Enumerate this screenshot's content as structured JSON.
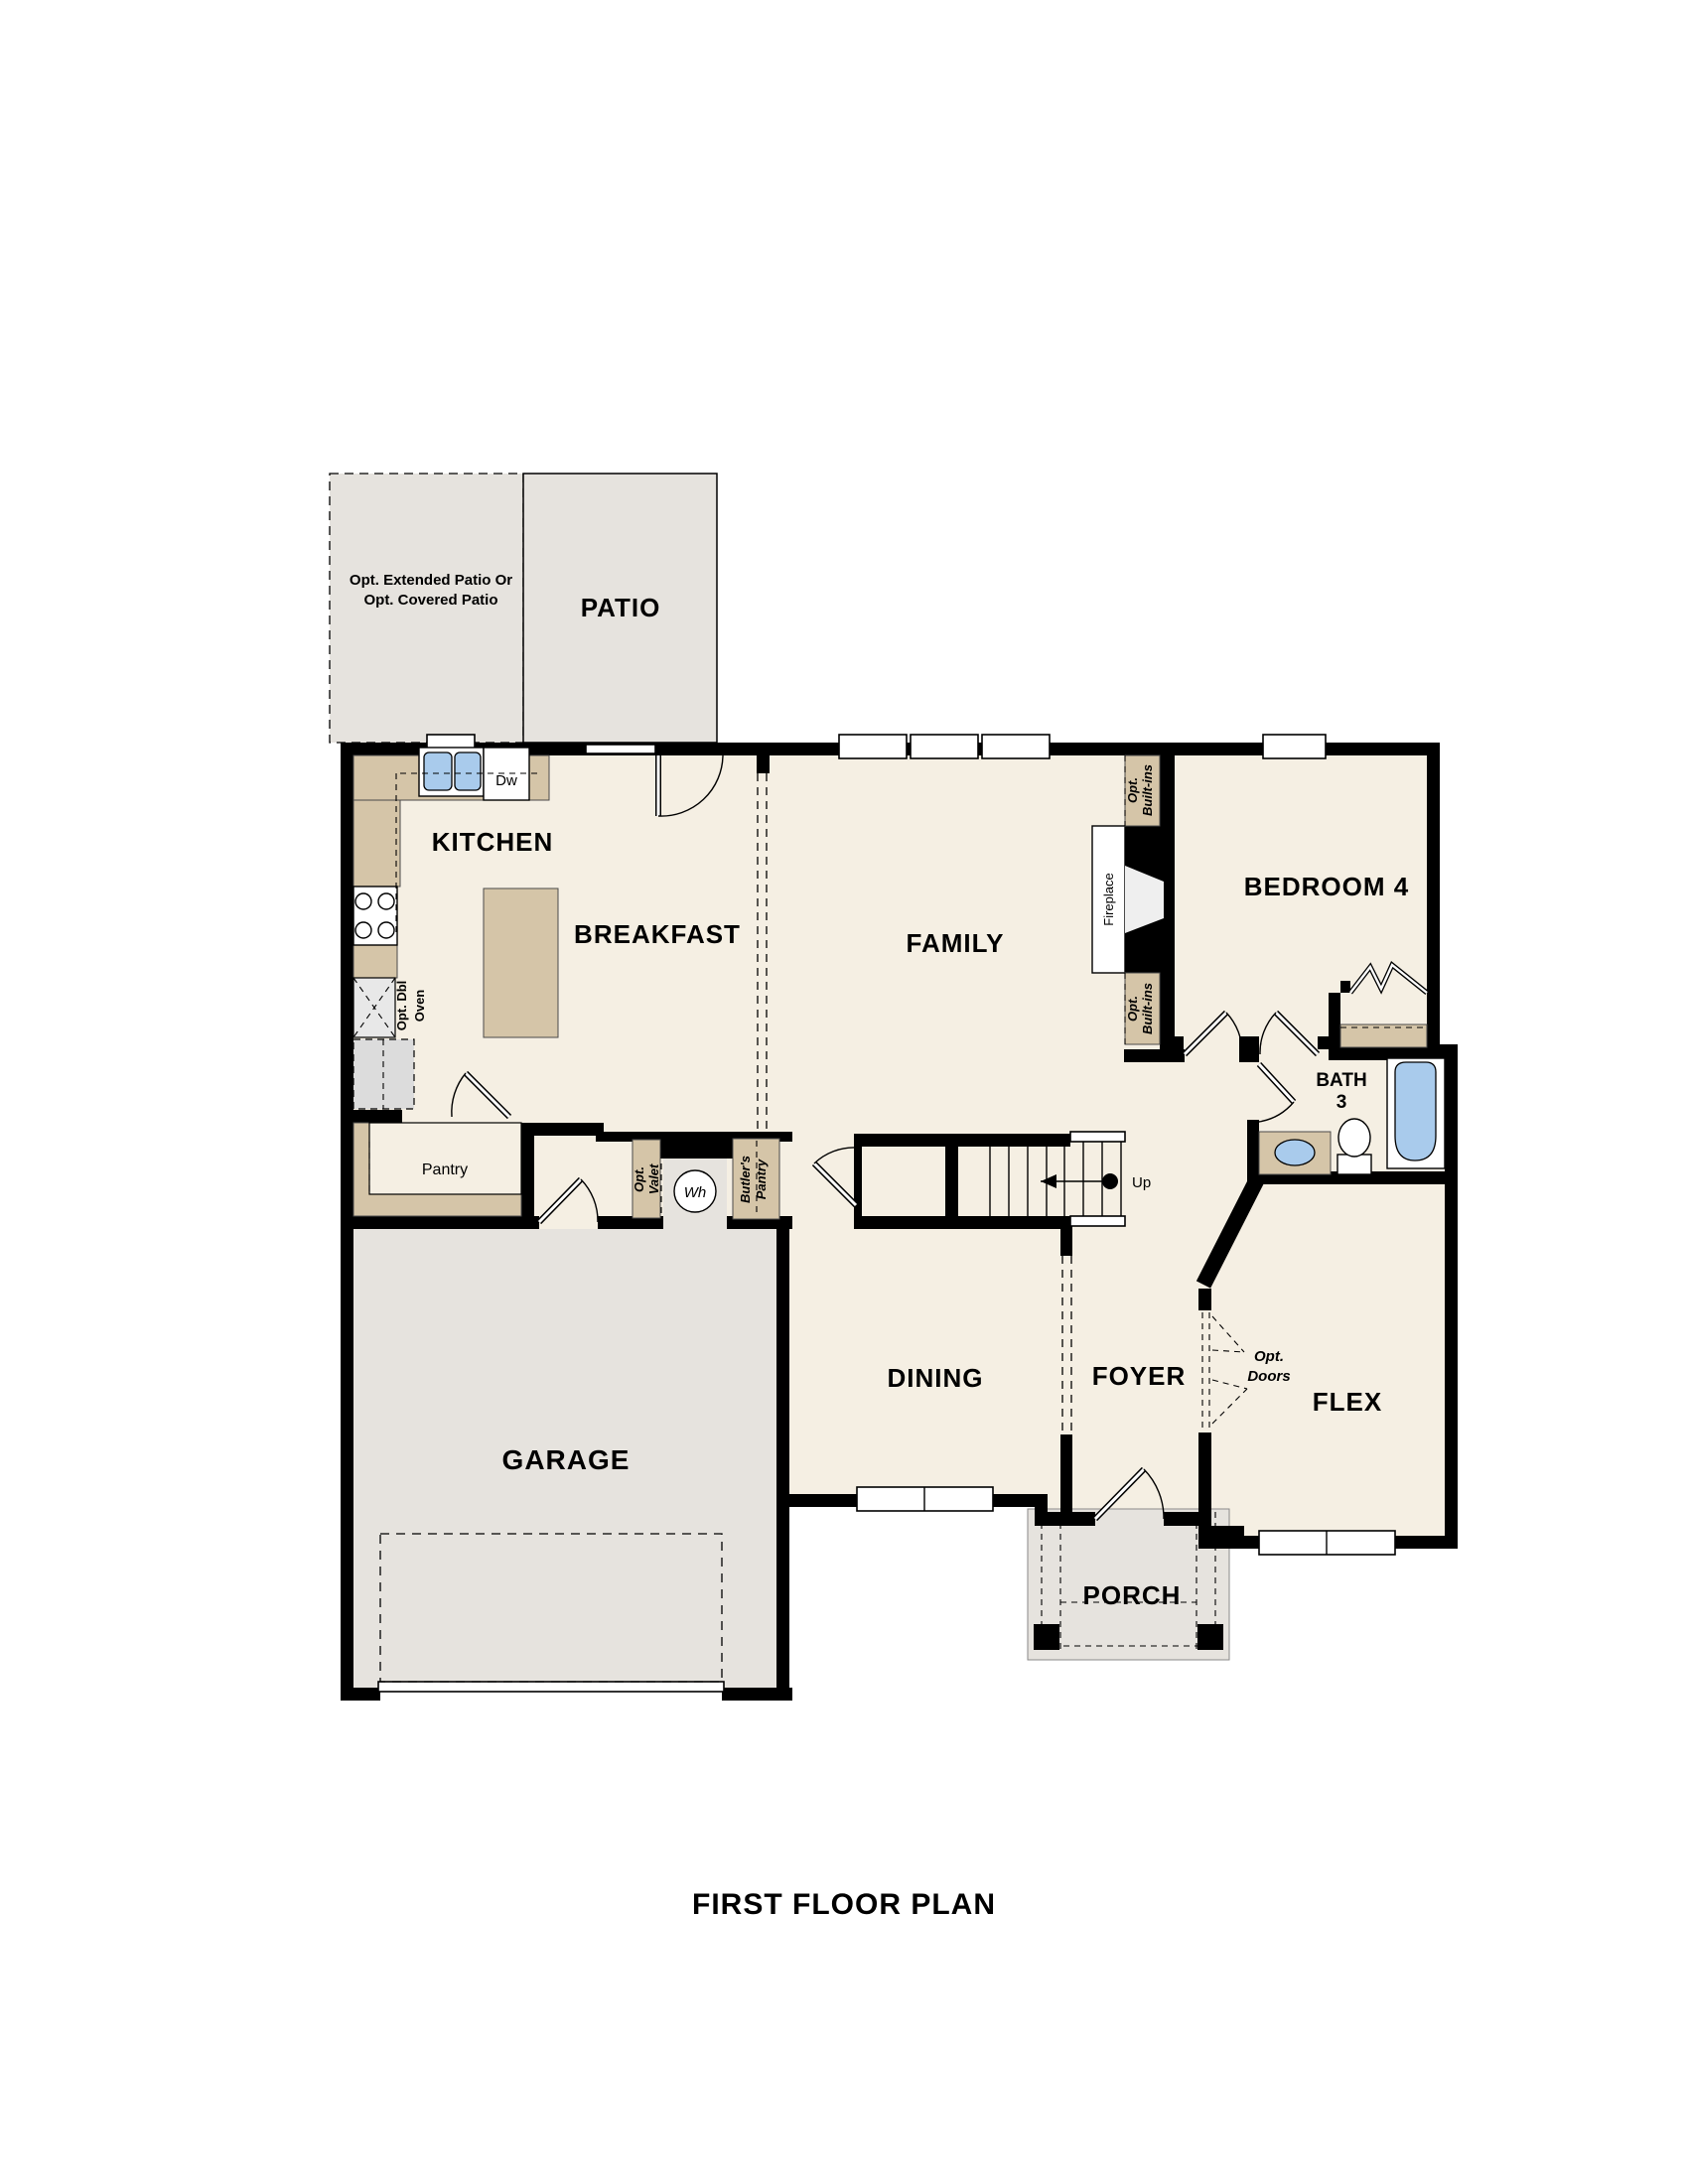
{
  "title": "FIRST FLOOR PLAN",
  "rooms": {
    "patio": "PATIO",
    "kitchen": "KITCHEN",
    "breakfast": "BREAKFAST",
    "family": "FAMILY",
    "bedroom4": "BEDROOM 4",
    "bath_line1": "BATH",
    "bath_line2": "3",
    "dining": "DINING",
    "foyer": "FOYER",
    "flex": "FLEX",
    "garage": "GARAGE",
    "porch": "PORCH",
    "pantry": "Pantry"
  },
  "labels": {
    "dw": "Dw",
    "wh": "Wh",
    "up": "Up",
    "fireplace": "Fireplace",
    "opt_patio_line1": "Opt. Extended Patio Or",
    "opt_patio_line2": "Opt. Covered Patio",
    "opt_doors_line1": "Opt.",
    "opt_doors_line2": "Doors",
    "opt_dbl_oven_line1": "Opt. Dbl",
    "opt_dbl_oven_line2": "Oven",
    "opt_valet_line1": "Opt.",
    "opt_valet_line2": "Valet",
    "butlers_line1": "Butler's",
    "butlers_line2": "Pantry",
    "builtins_line1": "Opt.",
    "builtins_line2": "Built-ins"
  },
  "colors": {
    "floor": "#f5efe3",
    "hardscape": "#e6e3de",
    "counter_tan": "#d5c5a8",
    "fixture_blue": "#a9cbec",
    "wall": "#000000"
  }
}
